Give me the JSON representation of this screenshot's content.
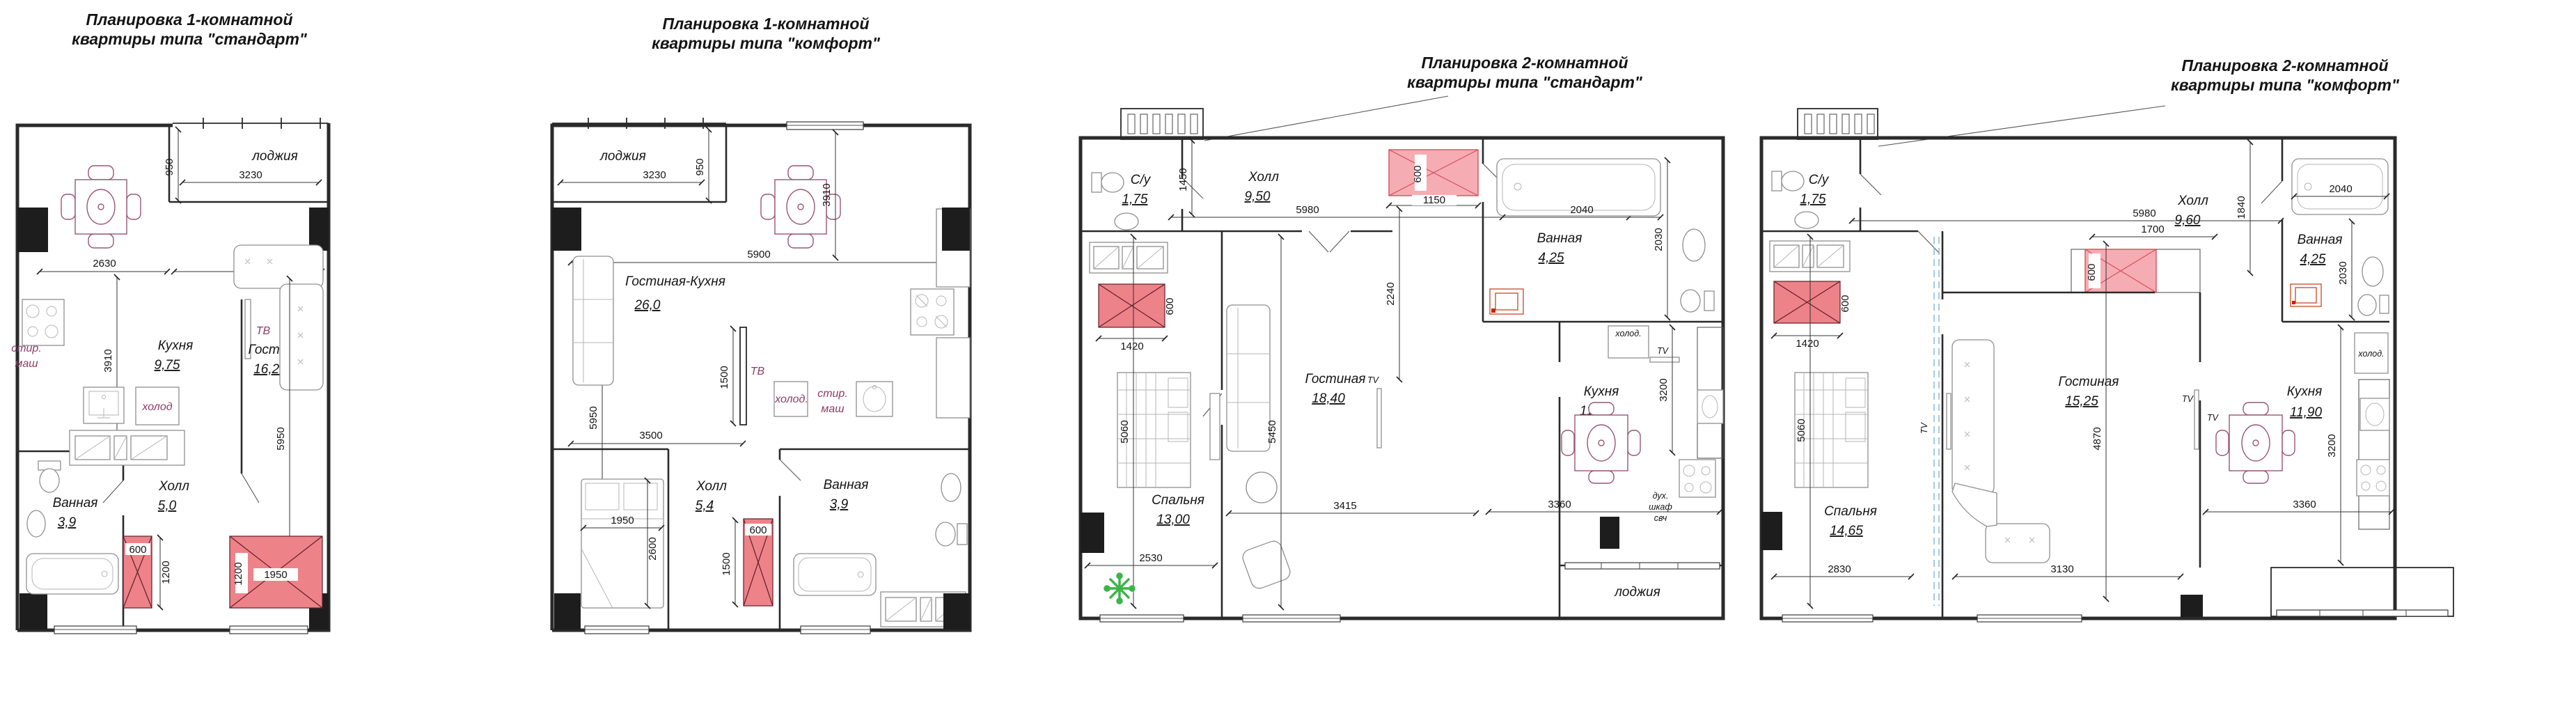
{
  "page": {
    "background": "#ffffff"
  },
  "colors": {
    "wall": "#2a2a2a",
    "furniture_outline": "#8f8f8f",
    "table_outline": "#9a5575",
    "shaft_fill": "#ee8289",
    "shaft_cross": "#5f1f28",
    "shaft_pink_fill": "#f5adb3",
    "shaft_pink_stroke": "#d84f5c",
    "plant_green": "#3cb44a",
    "purple_label": "#8e3c66",
    "blue_dashed": "#7fb3d8",
    "heater_orange": "#cc5530"
  },
  "plans": [
    {
      "name": "1k-standard",
      "title_lines": [
        "Планировка 1-комнатной",
        "квартиры типа \"стандарт\""
      ],
      "rooms": {
        "kitchen": {
          "name": "Кухня",
          "area": "9,75"
        },
        "living": {
          "name": "Гостиная",
          "area": "16,23"
        },
        "bath": {
          "name": "Ванная",
          "area": "3,9"
        },
        "hall": {
          "name": "Холл",
          "area": "5,0"
        },
        "loggia": {
          "name": "лоджия"
        }
      },
      "dims": {
        "loggia_d": "950",
        "loggia_w": "3230",
        "kitchen_w": "2630",
        "living_w": "3150",
        "kitchen_h": "3910",
        "living_h": "5950",
        "shaft1_w": "600",
        "shaft1_h": "1200",
        "shaft2_w": "1950",
        "shaft2_h": "1200"
      },
      "labels": {
        "washer1": "стир.",
        "washer2": "маш",
        "fridge": "холод",
        "tv": "ТВ"
      }
    },
    {
      "name": "1k-comfort",
      "title_lines": [
        "Планировка 1-комнатной",
        "квартиры типа \"комфорт\""
      ],
      "rooms": {
        "living_kitchen": {
          "name": "Гостиная-Кухня",
          "area": "26,0"
        },
        "hall": {
          "name": "Холл",
          "area": "5,4"
        },
        "bath": {
          "name": "Ванная",
          "area": "3,9"
        },
        "loggia": {
          "name": "лоджия"
        }
      },
      "dims": {
        "loggia_w": "3230",
        "loggia_d": "950",
        "main_w": "5900",
        "right_h": "3910",
        "left_h": "5950",
        "hall_w": "3500",
        "tv_wall_h": "1500",
        "bed_w": "1950",
        "bed_h": "2600",
        "shaft_w": "600",
        "shaft_h": "1500"
      },
      "labels": {
        "tv": "ТВ",
        "fridge": "холод.",
        "washer1": "стир.",
        "washer2": "маш"
      }
    },
    {
      "name": "2k-standard",
      "title_lines": [
        "Планировка 2-комнатной",
        "квартиры типа \"стандарт\""
      ],
      "rooms": {
        "su": {
          "name": "С/у",
          "area": "1,75"
        },
        "hall": {
          "name": "Холл",
          "area": "9,50"
        },
        "bath": {
          "name": "Ванная",
          "area": "4,25"
        },
        "bedroom": {
          "name": "Спальня",
          "area": "13,00"
        },
        "living": {
          "name": "Гостиная",
          "area": "18,40"
        },
        "kitchen": {
          "name": "Кухня",
          "area": "11,50"
        },
        "loggia": {
          "name": "лоджия"
        }
      },
      "dims": {
        "su_h": "1450",
        "hall_w": "5980",
        "shaft_tr_h": "600",
        "shaft_tr_w": "1150",
        "bath_w": "2040",
        "bath_h": "2030",
        "pass_h": "2240",
        "shaft_l_w": "1420",
        "shaft_l_h": "600",
        "bed_h": "5060",
        "bedroom_w": "2530",
        "living_h": "5450",
        "living_w": "3415",
        "kitchen_h": "3200",
        "kitchen_w": "3360"
      },
      "labels": {
        "fridge": "холод.",
        "tv_kitchen": "TV",
        "tv_living": "TV",
        "oven1": "дух.",
        "oven2": "шкаф",
        "oven3": "свч"
      }
    },
    {
      "name": "2k-comfort",
      "title_lines": [
        "Планировка 2-комнатной",
        "квартиры типа \"комфорт\""
      ],
      "rooms": {
        "su": {
          "name": "С/у",
          "area": "1,75"
        },
        "hall": {
          "name": "Холл",
          "area": "9,60"
        },
        "bath": {
          "name": "Ванная",
          "area": "4,25"
        },
        "bedroom": {
          "name": "Спальня",
          "area": "14,65"
        },
        "living": {
          "name": "Гостиная",
          "area": "15,25"
        },
        "kitchen": {
          "name": "Кухня",
          "area": "11,90"
        }
      },
      "dims": {
        "hall_w": "5980",
        "hall_h": "1840",
        "wardrobe_w": "1700",
        "shaft_m_h": "600",
        "shaft_l_w": "1420",
        "shaft_l_h": "600",
        "bath_w": "2040",
        "bath_h": "2030",
        "bed_h": "5060",
        "bedroom_w": "2830",
        "living_h": "4870",
        "living_w": "3130",
        "kitchen_h": "3200",
        "kitchen_w": "3360"
      },
      "labels": {
        "tv_bedroom": "TV",
        "tv_living": "TV",
        "tv_kitchen": "TV",
        "fridge": "холод."
      }
    }
  ]
}
